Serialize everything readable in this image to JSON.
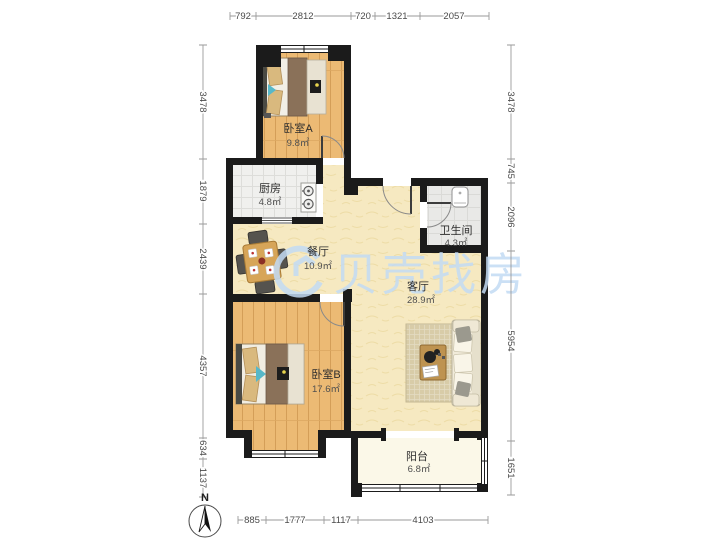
{
  "watermark": {
    "text": "贝壳找房",
    "color": "#C3DBF4"
  },
  "compass": {
    "label": "N"
  },
  "rooms": [
    {
      "key": "bedroom-a",
      "name": "卧室A",
      "area": "9.8㎡"
    },
    {
      "key": "kitchen",
      "name": "厨房",
      "area": "4.8㎡"
    },
    {
      "key": "dining",
      "name": "餐厅",
      "area": "10.9㎡"
    },
    {
      "key": "bathroom",
      "name": "卫生间",
      "area": "4.3㎡"
    },
    {
      "key": "living",
      "name": "客厅",
      "area": "28.9㎡"
    },
    {
      "key": "bedroom-b",
      "name": "卧室B",
      "area": "17.6㎡"
    },
    {
      "key": "balcony",
      "name": "阳台",
      "area": "6.8㎡"
    }
  ],
  "dimensions": {
    "top": [
      "792",
      "2812",
      "720",
      "1321",
      "2057"
    ],
    "bottom": [
      "885",
      "1777",
      "1117",
      "4103"
    ],
    "left": [
      "3478",
      "1879",
      "2439",
      "4357",
      "634",
      "1137"
    ],
    "right": [
      "3478",
      "745",
      "2096",
      "5954",
      "1651"
    ]
  },
  "colors": {
    "wall": "#1b1b1b",
    "wood": "#ECBA74",
    "living_floor": "#F6E9C1",
    "tile": "#EFEFED",
    "balcony_floor": "#FBF8E8",
    "watermark": "#C3DBF4"
  }
}
